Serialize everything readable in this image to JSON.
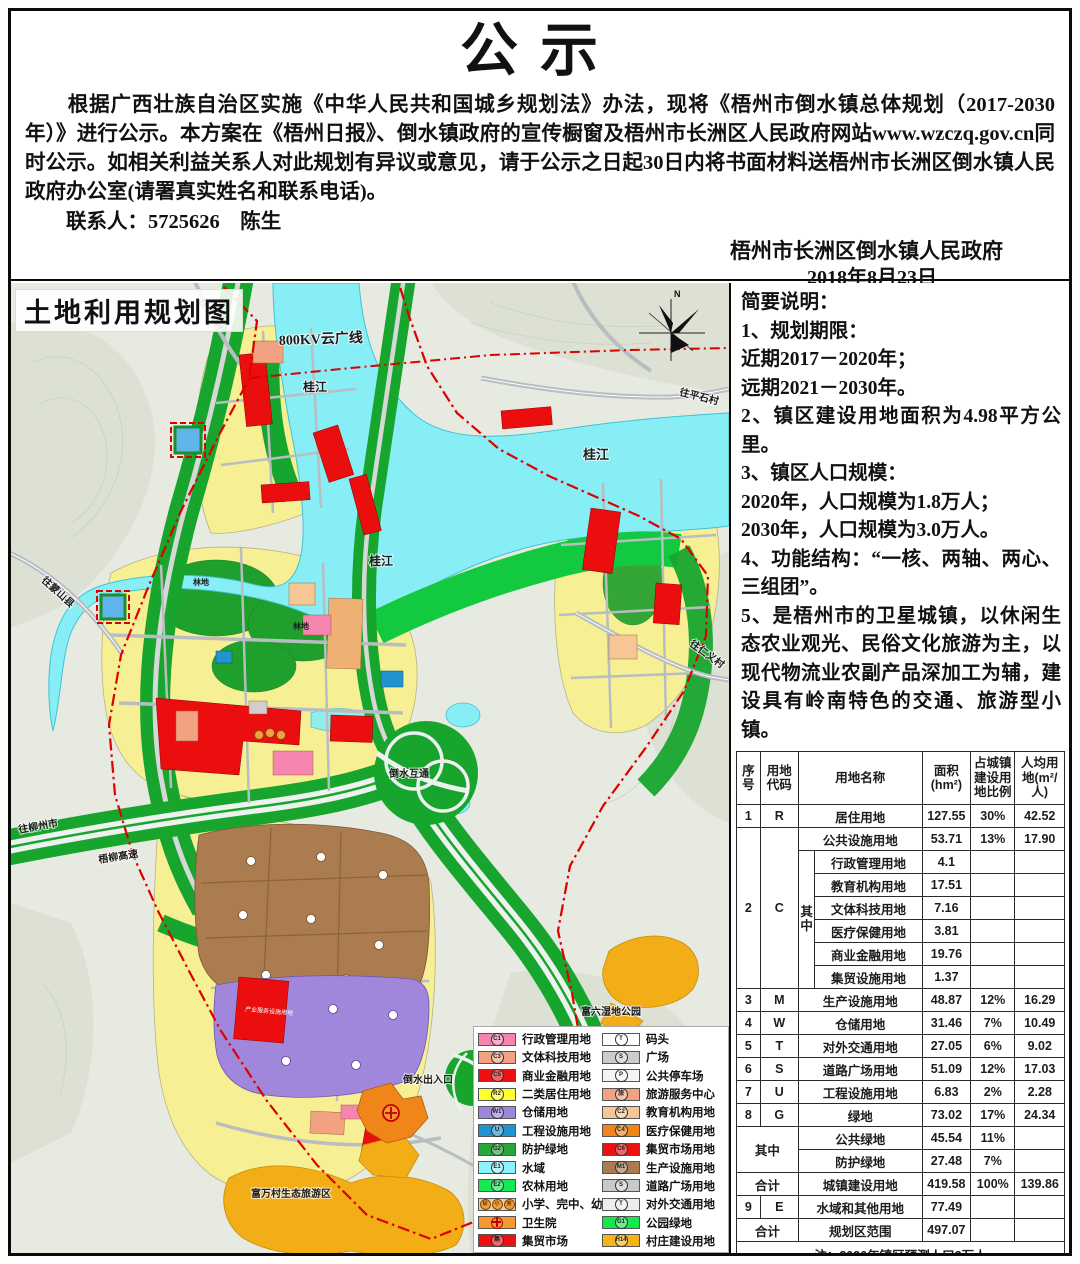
{
  "notice": {
    "title": "公示",
    "body": "　　根据广西壮族自治区实施《中华人民共和国城乡规划法》办法，现将《梧州市倒水镇总体规划（2017-2030年）》进行公示。本方案在《梧州日报》、倒水镇政府的宣传橱窗及梧州市长洲区人民政府网站www.wzczq.gov.cn同时公示。如相关利益关系人对此规划有异议或意见，请于公示之日起30日内将书面材料送梧州市长洲区倒水镇人民政府办公室(请署真实姓名和联系电话)。",
    "contact": "联系人：5725626　陈生",
    "issuer": "梧州市长洲区倒水镇人民政府",
    "date": "2018年8月23日"
  },
  "map": {
    "title": "土地利用规划图",
    "north_label": "N",
    "labels": {
      "power_line": "800KV云广线",
      "river1": "桂江",
      "river2": "桂江",
      "river3": "桂江",
      "road_pingshi": "往平石村",
      "road_renyi": "往仁义村",
      "road_mengshan": "往蒙山县",
      "road_puchong": "往蒲冲村",
      "road_liuzhou": "往柳州市",
      "expressway": "梧柳高速",
      "interchange": "倒水互通",
      "exit": "倒水出入口",
      "wetland_park": "富六湿地公园",
      "ecotourism": "富万村生态旅游区",
      "forest1": "林地",
      "forest2": "林地",
      "industry_service": "产业服务设施用地"
    },
    "legend": {
      "left": [
        {
          "code": "C1",
          "label": "行政管理用地",
          "color": "#f584ae"
        },
        {
          "code": "C3",
          "label": "文体科技用地",
          "color": "#f2a183"
        },
        {
          "code": "C5",
          "label": "商业金融用地",
          "color": "#ee1111"
        },
        {
          "code": "R2",
          "label": "二类居住用地",
          "color": "#ffff2e"
        },
        {
          "code": "W1",
          "label": "仓储用地",
          "color": "#9f86dd"
        },
        {
          "code": "U",
          "label": "工程设施用地",
          "color": "#2193cf"
        },
        {
          "code": "G2",
          "label": "防护绿地",
          "color": "#27a737"
        },
        {
          "code": "E1",
          "label": "水域",
          "color": "#8df3fa"
        },
        {
          "code": "E2",
          "label": "农林用地",
          "color": "#15e850"
        },
        {
          "codes": [
            "幼",
            "小",
            "完"
          ],
          "label": "小学、完中、幼儿园",
          "color": "#eecfa0"
        },
        {
          "code": "",
          "icon": "red-cross",
          "label": "卫生院",
          "color": "#f59a31"
        },
        {
          "code": "集",
          "label": "集贸市场",
          "color": "#ee1111"
        }
      ],
      "right": [
        {
          "code": "T",
          "label": "码头",
          "color": "#ffffff"
        },
        {
          "code": "S",
          "label": "广场",
          "color": "#cccccc"
        },
        {
          "code": "P",
          "label": "公共停车场",
          "color": "#f4f4f4"
        },
        {
          "code": "旅",
          "label": "旅游服务中心",
          "color": "#f2a183"
        },
        {
          "code": "C2",
          "label": "教育机构用地",
          "color": "#f6c695"
        },
        {
          "code": "C4",
          "label": "医疗保健用地",
          "color": "#f08519"
        },
        {
          "code": "C6",
          "label": "集贸市场用地",
          "color": "#ee1111"
        },
        {
          "code": "M1",
          "label": "生产设施用地",
          "color": "#ab7b4f"
        },
        {
          "code": "S",
          "label": "道路广场用地",
          "color": "#c9c9c9"
        },
        {
          "code": "T",
          "label": "对外交通用地",
          "color": "#ededed"
        },
        {
          "code": "G1",
          "label": "公园绿地",
          "color": "#15e84d"
        },
        {
          "code": "H14",
          "label": "村庄建设用地",
          "color": "#f5b519"
        }
      ]
    }
  },
  "brief": {
    "lines": [
      "简要说明：",
      "1、规划期限：",
      "近期2017－2020年；",
      "远期2021－2030年。",
      "2、镇区建设用地面积为4.98平方公里。",
      "3、镇区人口规模：",
      "2020年，人口规模为1.8万人；",
      "2030年，人口规模为3.0万人。",
      "4、功能结构：“一核、两轴、两心、三组团”。",
      "5、是梧州市的卫星城镇，以休闲生态农业观光、民俗文化旅游为主，以现代物流业农副产品深加工为辅，建设具有岭南特色的交通、旅游型小镇。"
    ]
  },
  "table": {
    "headers": [
      "序号",
      "用地代码",
      "用地名称",
      "面积(hm²)",
      "占城镇建设用地比例",
      "人均用地(m²/人)"
    ],
    "rows": {
      "qz": "其中",
      "r1": [
        "1",
        "R",
        "居住用地",
        "127.55",
        "30%",
        "42.52"
      ],
      "r2": [
        "2",
        "C",
        "公共设施用地",
        "53.71",
        "13%",
        "17.90"
      ],
      "c_sub": [
        [
          "行政管理用地",
          "4.1"
        ],
        [
          "教育机构用地",
          "17.51"
        ],
        [
          "文体科技用地",
          "7.16"
        ],
        [
          "医疗保健用地",
          "3.81"
        ],
        [
          "商业金融用地",
          "19.76"
        ],
        [
          "集贸设施用地",
          "1.37"
        ]
      ],
      "r3": [
        "3",
        "M",
        "生产设施用地",
        "48.87",
        "12%",
        "16.29"
      ],
      "r4": [
        "4",
        "W",
        "仓储用地",
        "31.46",
        "7%",
        "10.49"
      ],
      "r5": [
        "5",
        "T",
        "对外交通用地",
        "27.05",
        "6%",
        "9.02"
      ],
      "r6": [
        "6",
        "S",
        "道路广场用地",
        "51.09",
        "12%",
        "17.03"
      ],
      "r7": [
        "7",
        "U",
        "工程设施用地",
        "6.83",
        "2%",
        "2.28"
      ],
      "r8": [
        "8",
        "G",
        "绿地",
        "73.02",
        "17%",
        "24.34"
      ],
      "g_sub": [
        [
          "公共绿地",
          "45.54",
          "11%"
        ],
        [
          "防护绿地",
          "27.48",
          "7%"
        ]
      ],
      "total1": [
        "合计",
        "城镇建设用地",
        "419.58",
        "100%",
        "139.86"
      ],
      "r9": [
        "9",
        "E",
        "水域和其他用地",
        "77.49"
      ],
      "total2": [
        "合计",
        "规划区范围",
        "497.07"
      ],
      "note": "注：2030年镇区预测人口3万人"
    }
  }
}
